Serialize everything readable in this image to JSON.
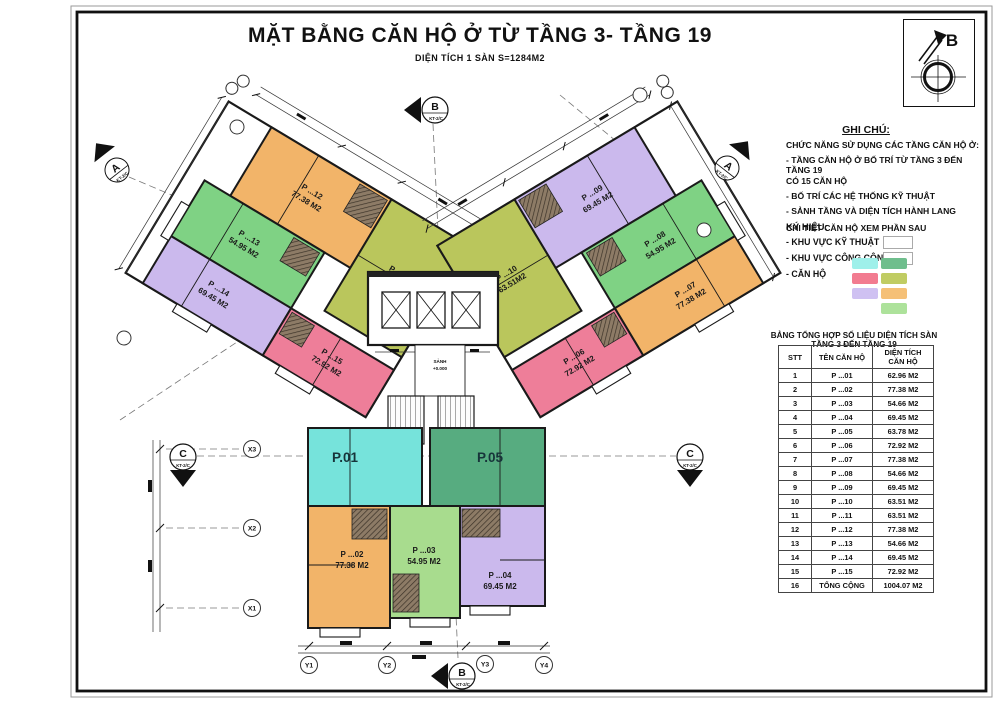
{
  "title": {
    "main": "MẶT BẰNG CĂN HỘ Ở TỪ TẦNG 3- TẦNG 19",
    "sub": "DIỆN TÍCH 1 SÀN S=1284M2"
  },
  "compass": {
    "north_letter": "B"
  },
  "notes": {
    "heading": "GHI CHÚ:",
    "lines": [
      "CHỨC NĂNG SỬ DỤNG CÁC TẦNG CĂN HỘ Ở:",
      "- TẦNG CĂN HỘ Ở BỐ TRÍ TỪ TẦNG 3 ĐẾN TẦNG 19",
      "CÓ 15 CĂN HỘ",
      "- BỐ TRÍ CÁC HỆ THỐNG KỸ THUẬT",
      "- SẢNH TẦNG VÀ DIỆN TÍCH HÀNH LANG",
      "CHI TIẾT CĂN HỘ XEM PHẦN SAU"
    ]
  },
  "legend": {
    "heading": "KÝ HIỆU:",
    "technical_label": "- KHU VỰC KỸ THUẬT",
    "public_label": "- KHU VỰC CÔNG CỘNG",
    "apartment_label": "- CĂN HỘ",
    "technical_color": "#ffffff",
    "public_color": "#ffffff",
    "apartment_colors": [
      "#9FF0EA",
      "#6FBE8D",
      "#F27B90",
      "#C0CC63",
      "#CFC1F2",
      "#F5C077",
      "#ADE29B"
    ]
  },
  "table": {
    "title": "BẢNG TỔNG HỢP SỐ LIỆU DIỆN TÍCH SÀN TẦNG 3 ĐẾN TẦNG 19",
    "headers": {
      "stt": "STT",
      "name": "TÊN CĂN HỘ",
      "area1": "DIỆN TÍCH",
      "area2": "CĂN HỘ"
    },
    "rows": [
      {
        "stt": "1",
        "name": "P ...01",
        "area": "62.96 M2"
      },
      {
        "stt": "2",
        "name": "P ...02",
        "area": "77.38 M2"
      },
      {
        "stt": "3",
        "name": "P ...03",
        "area": "54.66 M2"
      },
      {
        "stt": "4",
        "name": "P ...04",
        "area": "69.45 M2"
      },
      {
        "stt": "5",
        "name": "P ...05",
        "area": "63.78 M2"
      },
      {
        "stt": "6",
        "name": "P ...06",
        "area": "72.92 M2"
      },
      {
        "stt": "7",
        "name": "P ...07",
        "area": "77.38 M2"
      },
      {
        "stt": "8",
        "name": "P ...08",
        "area": "54.66 M2"
      },
      {
        "stt": "9",
        "name": "P ...09",
        "area": "69.45 M2"
      },
      {
        "stt": "10",
        "name": "P ...10",
        "area": "63.51 M2"
      },
      {
        "stt": "11",
        "name": "P ...11",
        "area": "63.51 M2"
      },
      {
        "stt": "12",
        "name": "P ...12",
        "area": "77.38 M2"
      },
      {
        "stt": "13",
        "name": "P ...13",
        "area": "54.66 M2"
      },
      {
        "stt": "14",
        "name": "P ...14",
        "area": "69.45 M2"
      },
      {
        "stt": "15",
        "name": "P ...15",
        "area": "72.92 M2"
      },
      {
        "stt": "16",
        "name": "TỔNG CỘNG",
        "area": "1004.07 M2"
      }
    ]
  },
  "plan": {
    "lobby": {
      "label": "SẢNH",
      "level": "+0.000"
    },
    "axis_x": [
      "X1",
      "X2",
      "X3"
    ],
    "axis_y": [
      "Y1",
      "Y2",
      "Y3",
      "Y4"
    ],
    "section_a": {
      "letter": "A",
      "tag": "KT-2/C"
    },
    "section_b": {
      "letter": "B",
      "tag": "KT-2/C"
    },
    "section_c": {
      "letter": "C",
      "tag": "KT-2/C"
    },
    "apartments": [
      {
        "id": "01",
        "name": "P.01",
        "area": "",
        "color": "#76E3DB"
      },
      {
        "id": "02",
        "name": "P ...02",
        "area": "77.38 M2",
        "color": "#F2B469"
      },
      {
        "id": "03",
        "name": "P ...03",
        "area": "54.95 M2",
        "color": "#A8DC8E"
      },
      {
        "id": "04",
        "name": "P ...04",
        "area": "69.45 M2",
        "color": "#CBB9ED"
      },
      {
        "id": "05",
        "name": "P.05",
        "area": "",
        "color": "#57AC80"
      },
      {
        "id": "06",
        "name": "P ...06",
        "area": "72.92 M2",
        "color": "#EE7E99"
      },
      {
        "id": "07",
        "name": "P ...07",
        "area": "77.38 M2",
        "color": "#F2B469"
      },
      {
        "id": "08",
        "name": "P ...08",
        "area": "54.95 M2",
        "color": "#7FD284"
      },
      {
        "id": "09",
        "name": "P ...09",
        "area": "69.45 M2",
        "color": "#CBB9ED"
      },
      {
        "id": "10",
        "name": "P ...10",
        "area": "63.51M2",
        "color": "#BAC65C"
      },
      {
        "id": "11",
        "name": "P ...11",
        "area": "63.51M2",
        "color": "#BAC65C"
      },
      {
        "id": "12",
        "name": "P ...12",
        "area": "77.38 M2",
        "color": "#F2B469"
      },
      {
        "id": "13",
        "name": "P ...13",
        "area": "54.95 M2",
        "color": "#7FD284"
      },
      {
        "id": "14",
        "name": "P ...14",
        "area": "69.45 M2",
        "color": "#CBB9ED"
      },
      {
        "id": "15",
        "name": "P ...15",
        "area": "72.92 M2",
        "color": "#EE7E99"
      }
    ]
  }
}
